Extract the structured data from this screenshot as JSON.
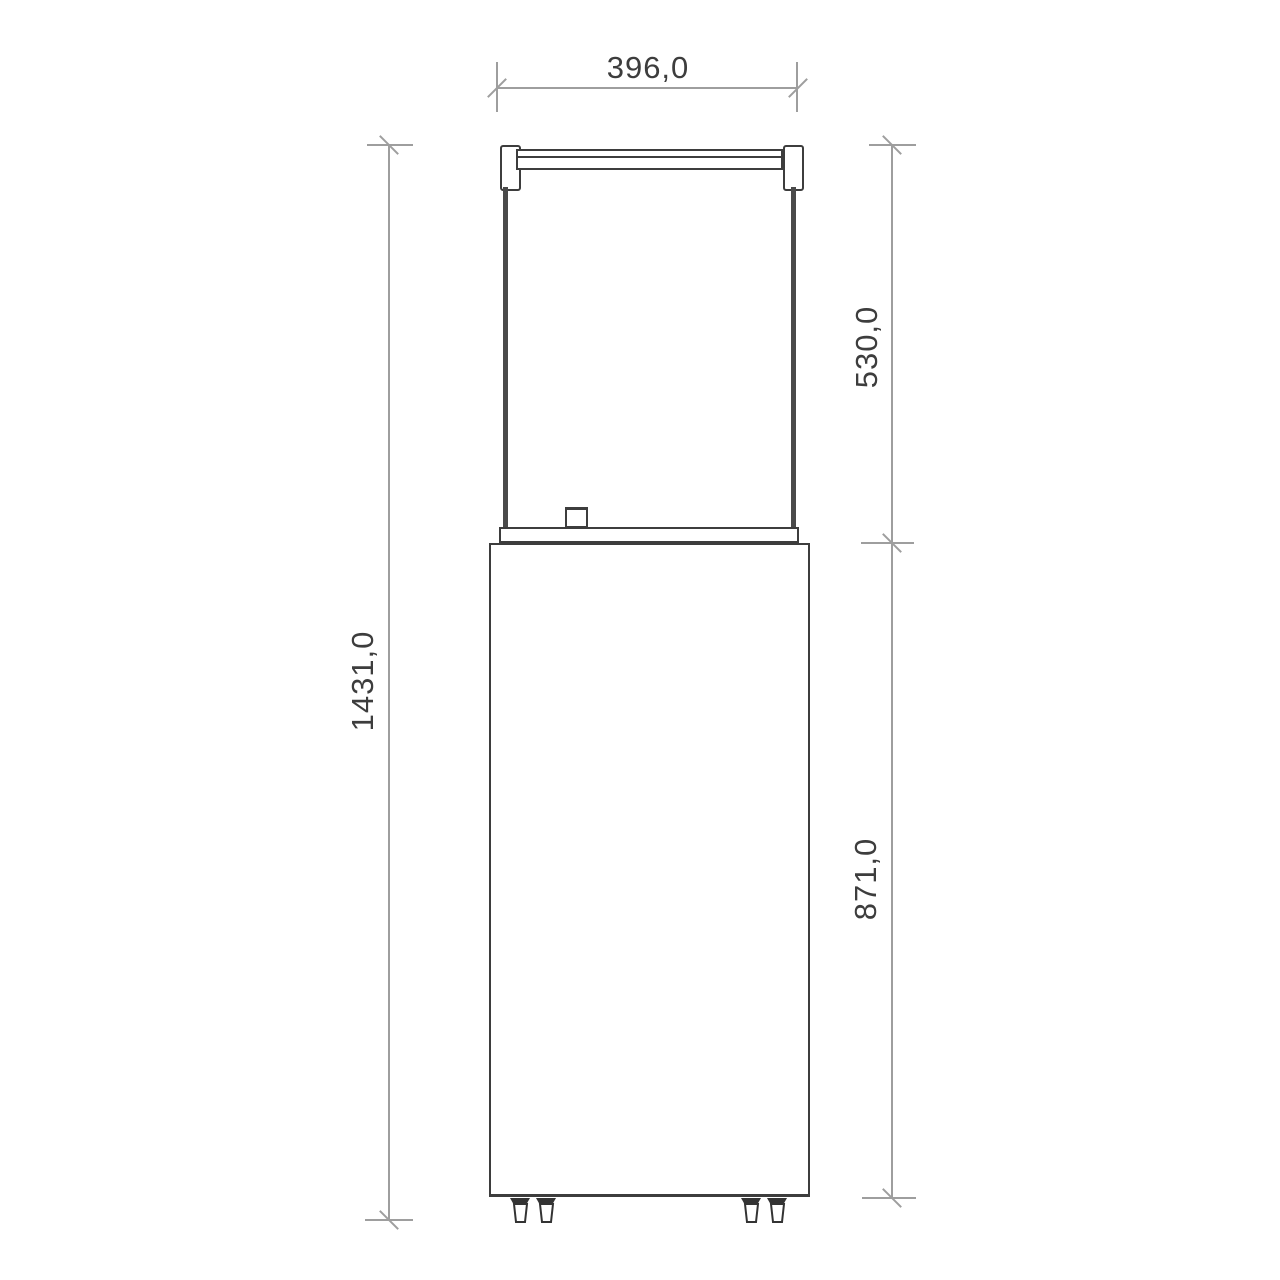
{
  "drawing": {
    "type": "technical-dimension-drawing",
    "view": "front",
    "dimensions": {
      "width_label": "396,0",
      "glass_height_label": "530,0",
      "body_height_label": "871,0",
      "total_height_label": "1431,0"
    },
    "colors": {
      "background": "#ffffff",
      "outline": "#3d3d3d",
      "glass_edge": "#4a4a4a",
      "dimension": "#9e9e9e",
      "text": "#3d3d3d"
    }
  }
}
